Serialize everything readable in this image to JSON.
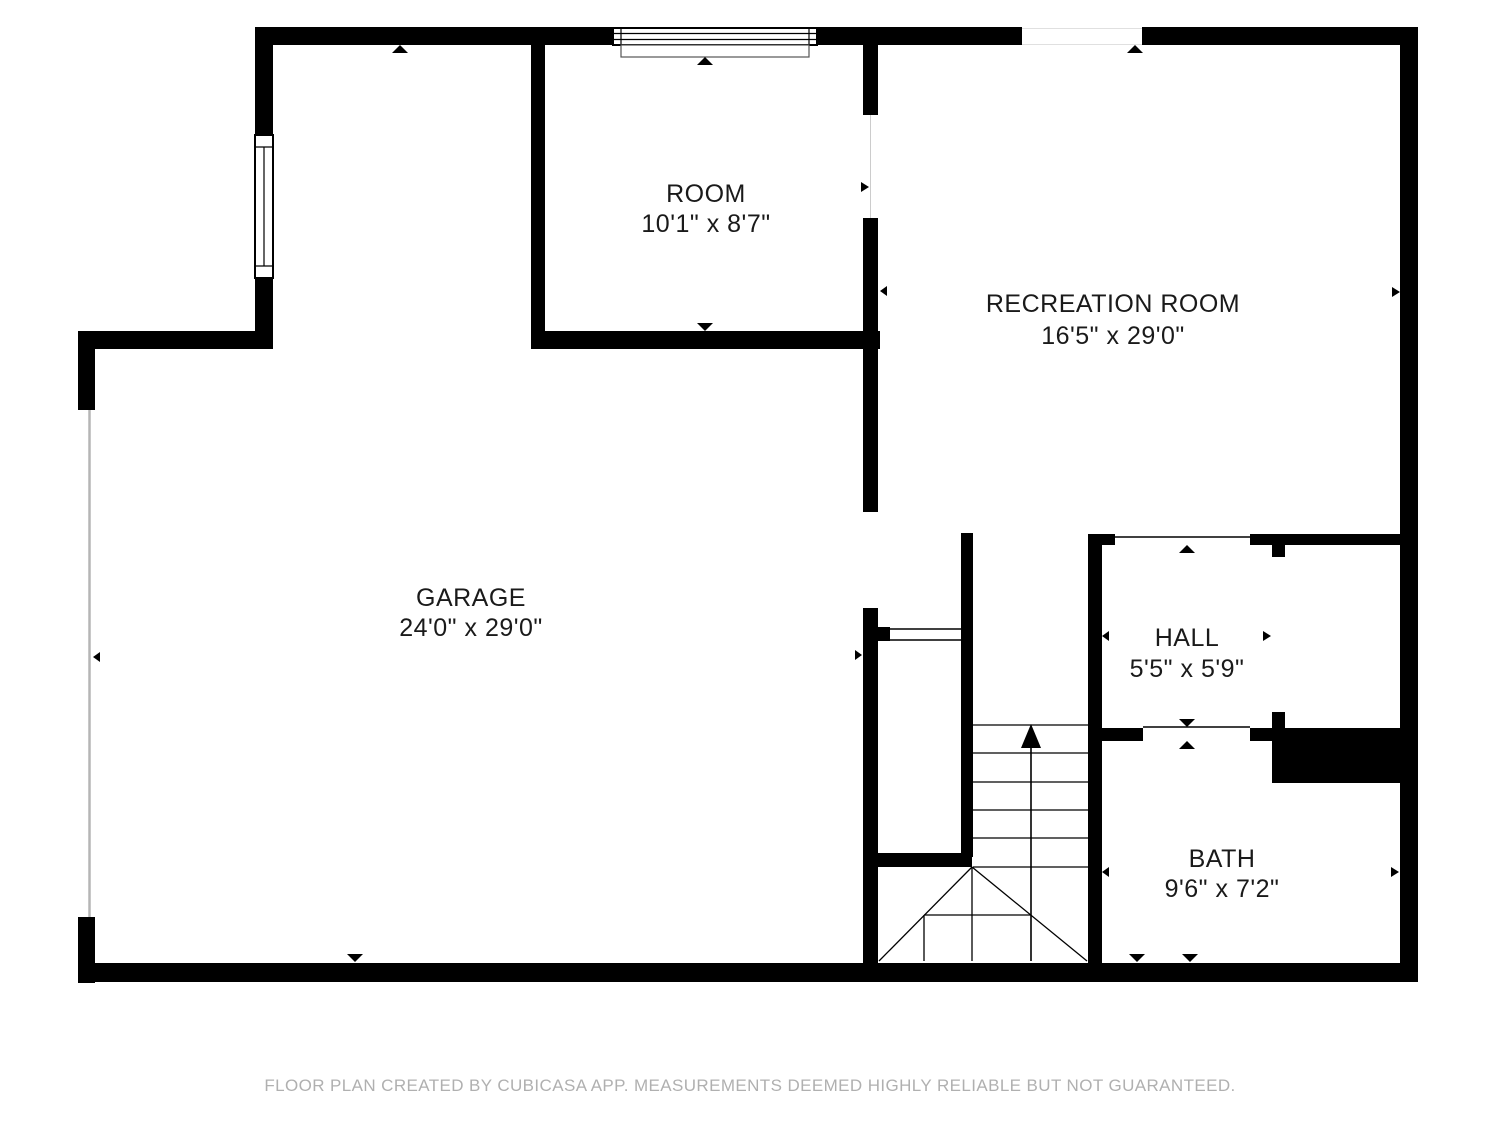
{
  "rooms": [
    {
      "name": "ROOM",
      "dims": "10'1\" x 8'7\""
    },
    {
      "name": "RECREATION ROOM",
      "dims": "16'5\" x 29'0\""
    },
    {
      "name": "GARAGE",
      "dims": "24'0\" x 29'0\""
    },
    {
      "name": "HALL",
      "dims": "5'5\" x 5'9\""
    },
    {
      "name": "BATH",
      "dims": "9'6\" x 7'2\""
    }
  ],
  "stairs": {
    "direction": "up"
  },
  "footer": {
    "text": "FLOOR PLAN CREATED BY CUBICASA APP. MEASUREMENTS DEEMED HIGHLY RELIABLE BUT NOT GUARANTEED."
  },
  "colors": {
    "wall": "#000000",
    "background": "#ffffff",
    "label": "#1a1a1a",
    "footer_text": "#b0b0b0",
    "garage_door_line": "#b5b5b5"
  },
  "icons": {
    "direction_marker": "small-black-triangle",
    "stairs_arrow": "up-arrow"
  }
}
